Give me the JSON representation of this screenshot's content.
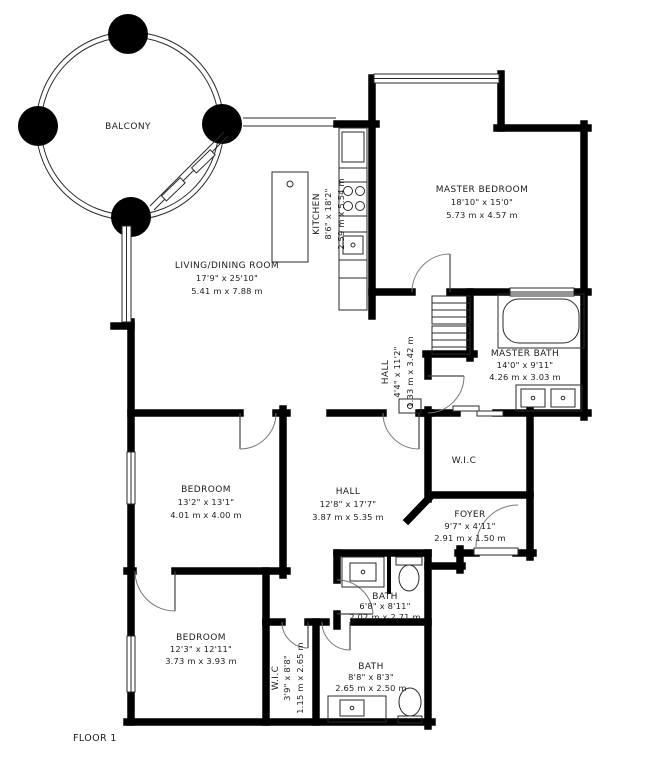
{
  "plan": {
    "floor_label": "FLOOR 1",
    "colors": {
      "wall": "#000000",
      "line": "#2a2a2a",
      "text": "#1c1c1c",
      "background": "#ffffff"
    },
    "rooms": [
      {
        "name": "BALCONY",
        "imperial": "",
        "metric": ""
      },
      {
        "name": "LIVING/DINING ROOM",
        "imperial": "17'9\" x 25'10\"",
        "metric": "5.41 m x 7.88 m"
      },
      {
        "name": "KITCHEN",
        "imperial": "8'6\" x 18'2\"",
        "metric": "2.59 m x 5.54 m"
      },
      {
        "name": "MASTER BEDROOM",
        "imperial": "18'10\" x 15'0\"",
        "metric": "5.73 m x 4.57 m"
      },
      {
        "name": "MASTER BATH",
        "imperial": "14'0\" x 9'11\"",
        "metric": "4.26 m x 3.03 m"
      },
      {
        "name": "HALL",
        "imperial": "4'4\" x 11'2\"",
        "metric": "1.33 m x 3.42 m"
      },
      {
        "name": "W.I.C",
        "imperial": "",
        "metric": ""
      },
      {
        "name": "HALL",
        "imperial": "12'8\" x 17'7\"",
        "metric": "3.87 m x 5.35 m"
      },
      {
        "name": "BEDROOM",
        "imperial": "13'2\" x 13'1\"",
        "metric": "4.01 m x 4.00 m"
      },
      {
        "name": "FOYER",
        "imperial": "9'7\" x 4'11\"",
        "metric": "2.91 m x 1.50 m"
      },
      {
        "name": "BEDROOM",
        "imperial": "12'3\" x 12'11\"",
        "metric": "3.73 m x 3.93 m"
      },
      {
        "name": "BATH",
        "imperial": "6'8\" x 8'11\"",
        "metric": "2.02 m x 2.71 m"
      },
      {
        "name": "W.I.C",
        "imperial": "3'9\" x 8'8\"",
        "metric": "1.15 m x 2.65 m"
      },
      {
        "name": "BATH",
        "imperial": "8'8\" x 8'3\"",
        "metric": "2.65 m x 2.50 m"
      }
    ]
  }
}
